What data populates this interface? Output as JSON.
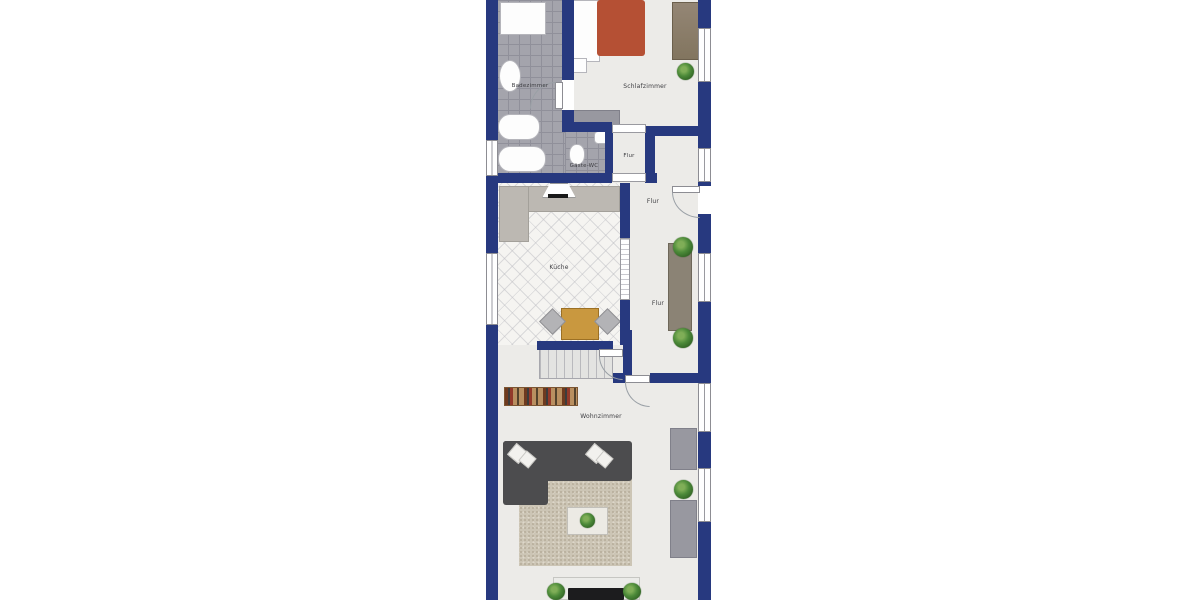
{
  "title": "Wohnung Grundriss (floor plan)",
  "rooms": {
    "badezimmer": {
      "label": "Badezimmer"
    },
    "schlafzimmer": {
      "label": "Schlafzimmer"
    },
    "gaeste_wc": {
      "label": "Gäste-WC"
    },
    "flur_klein": {
      "label": "Flur"
    },
    "flur_oben": {
      "label": "Flur"
    },
    "flur": {
      "label": "Flur"
    },
    "kueche": {
      "label": "Küche"
    },
    "wohnzimmer": {
      "label": "Wohnzimmer"
    }
  },
  "colors": {
    "wall": "#27397f",
    "floor_light": "#ecebe8",
    "bath_tile": "#a4a4ac",
    "kitchen_floor": "#f5f4f1",
    "counter": "#bcb8b2",
    "bed_blanket": "#b55034",
    "wardrobe": "#8a7d6c",
    "sofa": "#4c4c4e",
    "rug": "#ccc5b5",
    "table_wood": "#c9983f",
    "sideboard": "#8b8375",
    "radiator": "#9898a0",
    "plant": "#4c8a39"
  }
}
